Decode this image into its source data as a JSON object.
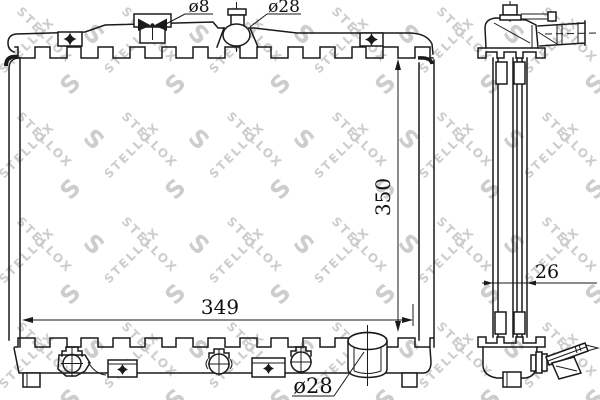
{
  "watermark": {
    "brand": "STELLOX",
    "logo_letter": "S",
    "color": "#cdcdcd"
  },
  "labels": {
    "top_fitting_diameter": "ø8",
    "filler_diameter": "ø28",
    "core_height": "350",
    "core_width": "349",
    "core_depth": "26",
    "outlet_diameter": "ø28"
  },
  "colors": {
    "line": "#1a1a1a",
    "background": "#ffffff",
    "dimension_text": "#111111"
  }
}
